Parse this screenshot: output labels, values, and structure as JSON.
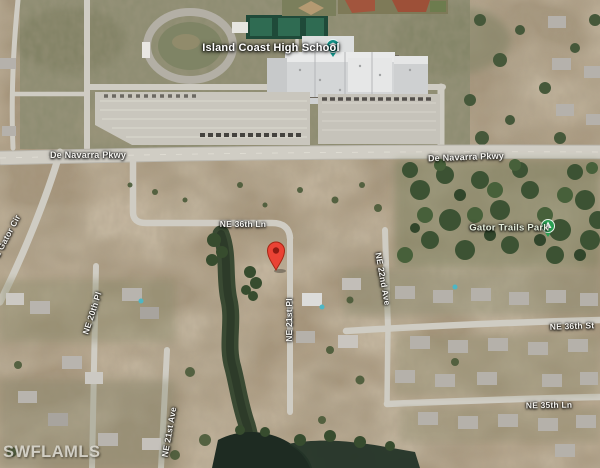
{
  "map": {
    "type": "satellite-view",
    "watermark": "SWFLAMLS",
    "pois": {
      "school": {
        "label": "Island Coast High School",
        "pin_color": "#12948a"
      },
      "park": {
        "label": "Gator Trails Park",
        "pin_color": "#2aa054"
      },
      "listing_marker": {
        "description": "red-map-pin",
        "color": "#ea4335"
      }
    },
    "road_labels": {
      "de_navarra_w": "De Navarra Pkwy",
      "de_navarra_e": "De Navarra Pkwy",
      "ne_36th_ln": "NE 36th Ln",
      "ne_36th_st": "NE 36th St",
      "ne_35th_ln": "NE 35th Ln",
      "ne_20th_pl": "NE 20th Pl",
      "ne_21st_ave": "NE 21st Ave",
      "ne_21st_pl": "NE 21st Pl",
      "ne_22nd_ave": "NE 22nd Ave",
      "e_gator_cir": "E Gator Cir"
    },
    "colors": {
      "dirt": "#a5947a",
      "grass": "#8e8d72",
      "road": "#d0cdc4",
      "trees": "#3f5634",
      "water": "#1e2b22",
      "marker_red": "#ea4335"
    }
  }
}
